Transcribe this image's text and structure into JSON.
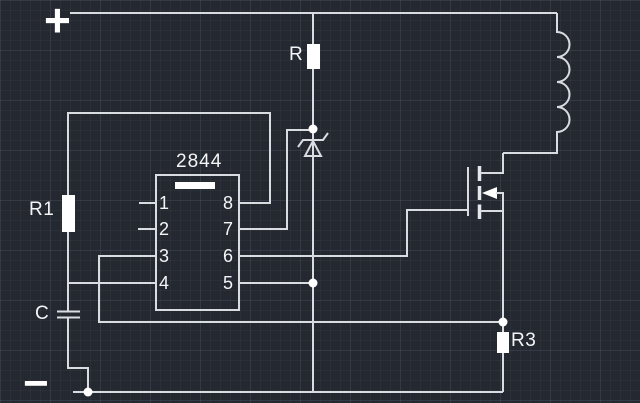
{
  "canvas": {
    "width": 640,
    "height": 403,
    "bg_color": "#242931",
    "grid_minor_color": "#2b313b",
    "grid_major_color": "#303844",
    "wire_color": "#d9dce1",
    "symbol_fill_color": "#ffffff"
  },
  "terminals": {
    "positive": "+",
    "negative": "−"
  },
  "components": {
    "resistor_top": {
      "label": "R"
    },
    "resistor_r1": {
      "label": "R1"
    },
    "capacitor_c": {
      "label": "C"
    },
    "resistor_r3": {
      "label": "R3"
    },
    "ic": {
      "part_number": "2844",
      "pins_left": [
        "1",
        "2",
        "3",
        "4"
      ],
      "pins_right": [
        "8",
        "7",
        "6",
        "5"
      ]
    },
    "zener_diode": {
      "name": "zener-diode"
    },
    "inductor": {
      "name": "inductor-coil"
    },
    "mosfet": {
      "name": "n-channel-mosfet"
    }
  }
}
